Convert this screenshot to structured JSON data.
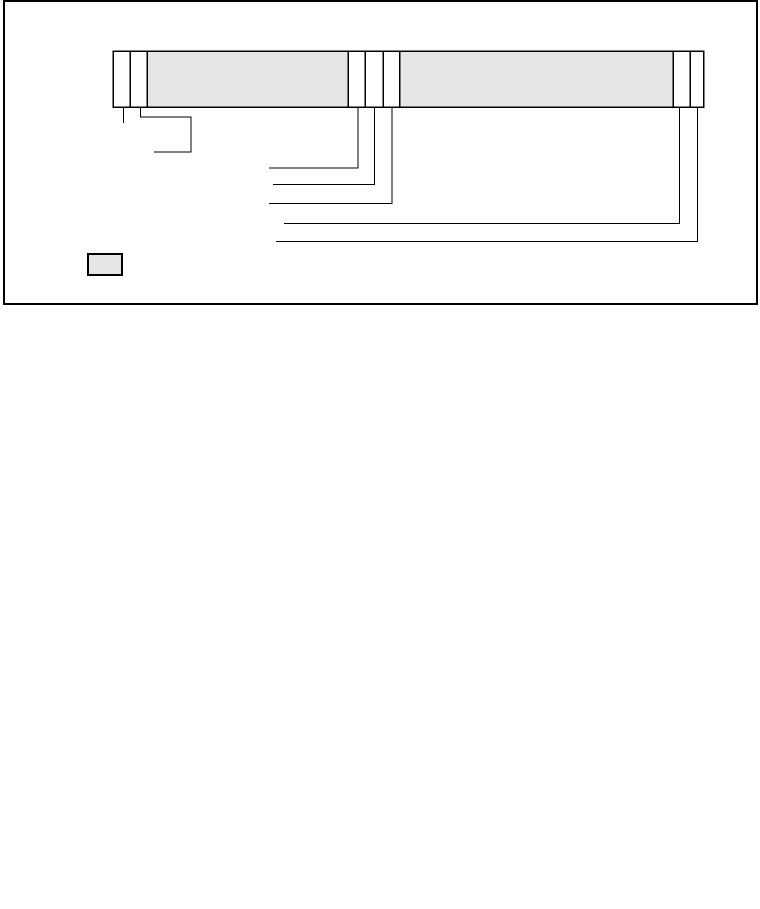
{
  "canvas": {
    "width": 760,
    "height": 909,
    "background": "#ffffff"
  },
  "colors": {
    "stroke": "#000000",
    "shaded_fill": "#e6e6e6",
    "unshaded_fill": "#ffffff"
  },
  "frame": {
    "x": 4,
    "y": 1,
    "width": 753,
    "height": 303
  },
  "register_bar": {
    "y": 51,
    "height": 56,
    "cells": [
      {
        "name": "field-cell-1",
        "x": 113,
        "width": 17,
        "shaded": false
      },
      {
        "name": "field-cell-2",
        "x": 130,
        "width": 17,
        "shaded": false
      },
      {
        "name": "field-cell-3",
        "x": 147,
        "width": 201,
        "shaded": true
      },
      {
        "name": "field-cell-4",
        "x": 348,
        "width": 17,
        "shaded": false
      },
      {
        "name": "field-cell-5",
        "x": 365,
        "width": 18,
        "shaded": false
      },
      {
        "name": "field-cell-6",
        "x": 383,
        "width": 16.5,
        "shaded": false
      },
      {
        "name": "field-cell-7",
        "x": 399.5,
        "width": 273.5,
        "shaded": true
      },
      {
        "name": "field-cell-8",
        "x": 673,
        "width": 17,
        "shaded": false
      },
      {
        "name": "field-cell-9",
        "x": 690,
        "width": 13.5,
        "shaded": false
      }
    ]
  },
  "callout_lines": [
    {
      "name": "callout-line-1",
      "points": [
        [
          123.5,
          107
        ],
        [
          123.5,
          123
        ]
      ]
    },
    {
      "name": "callout-line-2",
      "points": [
        [
          140.5,
          107
        ],
        [
          140.5,
          117
        ],
        [
          191,
          117
        ],
        [
          191,
          152
        ],
        [
          154,
          152
        ]
      ]
    },
    {
      "name": "callout-line-3",
      "points": [
        [
          358,
          107
        ],
        [
          358,
          168
        ],
        [
          269,
          168
        ]
      ]
    },
    {
      "name": "callout-line-4",
      "points": [
        [
          374.5,
          107
        ],
        [
          374.5,
          184.5
        ],
        [
          273,
          184.5
        ]
      ]
    },
    {
      "name": "callout-line-5",
      "points": [
        [
          392,
          107
        ],
        [
          392,
          203.5
        ],
        [
          269,
          203.5
        ]
      ]
    },
    {
      "name": "callout-line-6",
      "points": [
        [
          679.5,
          107
        ],
        [
          679.5,
          223.5
        ],
        [
          284,
          223.5
        ]
      ]
    },
    {
      "name": "callout-line-7",
      "points": [
        [
          697.5,
          107
        ],
        [
          697.5,
          241.5
        ],
        [
          276,
          241.5
        ]
      ]
    }
  ],
  "legend": {
    "swatch": {
      "x": 88,
      "y": 254,
      "width": 34,
      "height": 21,
      "shaded": true
    }
  }
}
